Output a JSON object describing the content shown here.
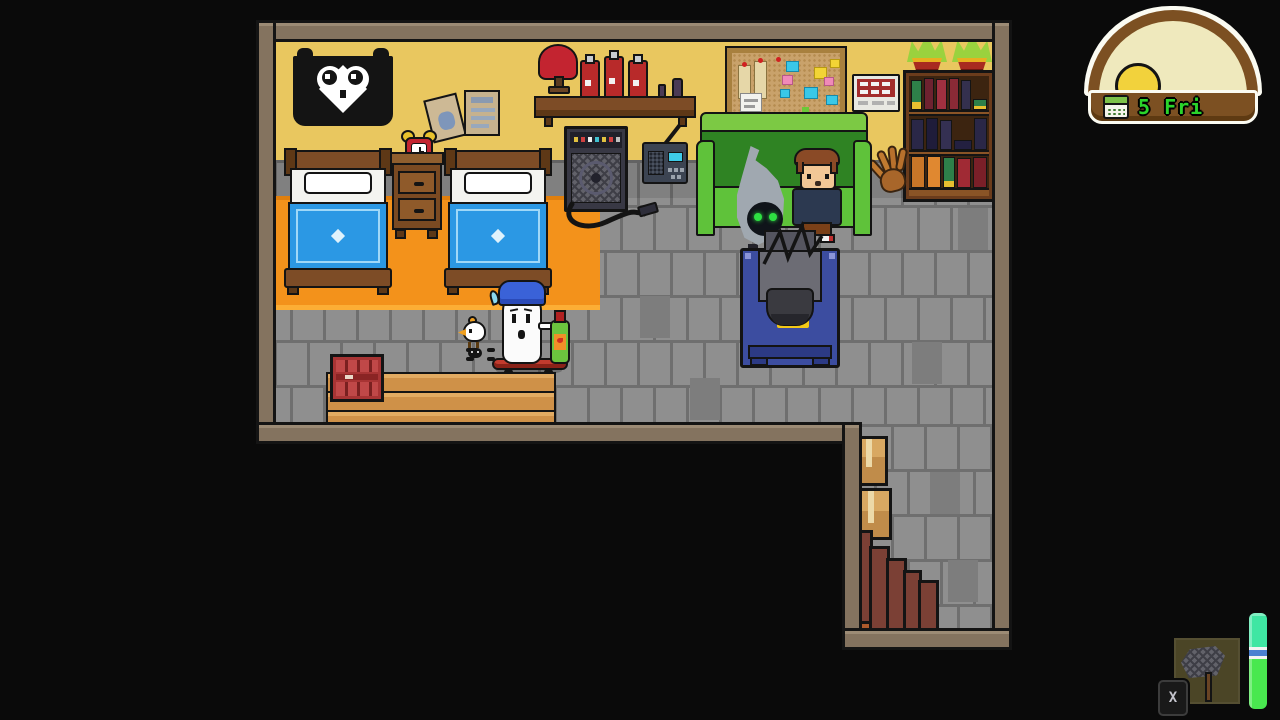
{
  "app": {
    "name": "pixel-life-sim",
    "scene": "attic-bedroom"
  },
  "hud": {
    "clock": {
      "date_label": "5 Fri",
      "icon": "calendar-icon",
      "text_color": "#2bd42b",
      "frame_color": "#7c5022",
      "sky_color": "#efe9bd",
      "sun_color": "#f2d23c"
    },
    "tool_slot": {
      "item": "bug-net",
      "key_hint": "X",
      "slot_color": "#4b4526"
    },
    "status_bar": {
      "top_color": "#3fe6a3",
      "divider_color": "#4a7fd0",
      "bottom_color": "#49e84f"
    }
  },
  "scene": {
    "palette": {
      "wall": "#e9c75f",
      "floor": "#8f8f8f",
      "rug": "#f3921b",
      "couch": "#5fc23a",
      "tv_cabinet": "#3c4da0",
      "blanket": "#2b98e4",
      "wood": "#7d4c26"
    },
    "objects": [
      "cat-banner",
      "wall-posters",
      "wall-shelf",
      "lamp",
      "hot-sauce-bottles",
      "guitar-amp",
      "radio",
      "corkboard",
      "wall-sign",
      "bookshelf",
      "potted-plants",
      "baseball-glove",
      "bed-left",
      "bed-right",
      "nightstand",
      "alarm-clock",
      "couch",
      "tv",
      "skateboard",
      "wooden-platform",
      "crate",
      "cardboard-boxes",
      "staircase"
    ],
    "characters": [
      "ghost-player",
      "chick-pet",
      "beetle-pet",
      "hooded-alien-npc",
      "boy-npc"
    ]
  }
}
